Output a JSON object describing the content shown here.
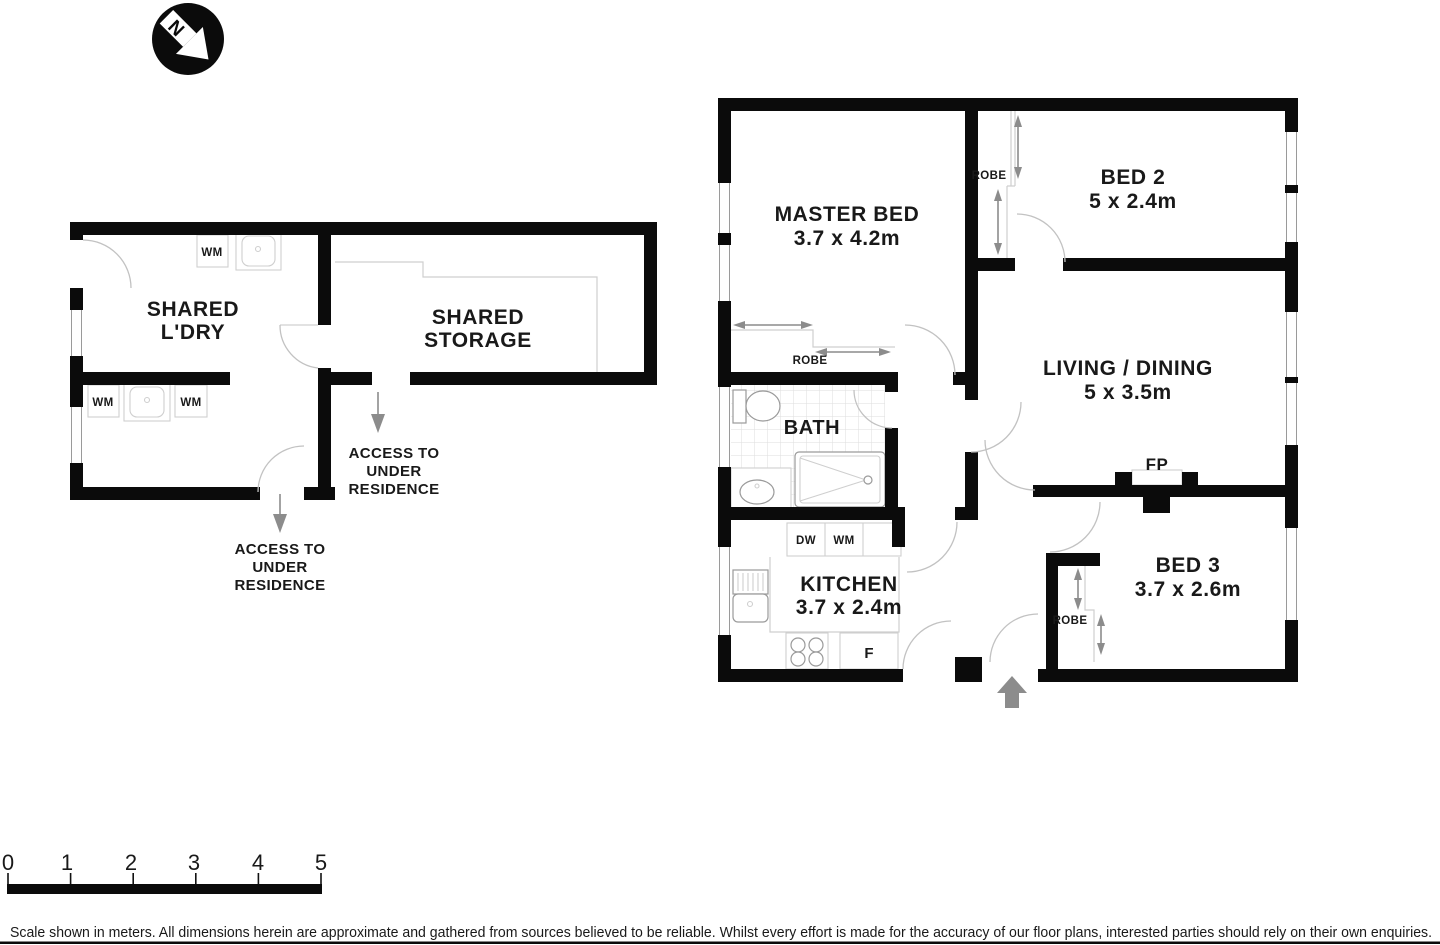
{
  "north": {
    "label": "N"
  },
  "out": {
    "laundry": {
      "l1": "SHARED",
      "l2": "L'DRY"
    },
    "storage": {
      "l1": "SHARED",
      "l2": "STORAGE"
    },
    "wm": "WM",
    "access": {
      "l1": "ACCESS TO",
      "l2": "UNDER",
      "l3": "RESIDENCE"
    }
  },
  "res": {
    "master": {
      "name": "MASTER BED",
      "dims": "3.7 x 4.2m"
    },
    "bed2": {
      "name": "BED 2",
      "dims": "5 x 2.4m"
    },
    "living": {
      "name": "LIVING / DINING",
      "dims": "5 x 3.5m"
    },
    "bed3": {
      "name": "BED 3",
      "dims": "3.7 x 2.6m"
    },
    "kitchen": {
      "name": "KITCHEN",
      "dims": "3.7 x 2.4m"
    },
    "bath": {
      "name": "BATH"
    },
    "labels": {
      "robe": "ROBE",
      "fp": "FP",
      "dw": "DW",
      "wm": "WM",
      "fridge": "F"
    }
  },
  "scale": {
    "ticks": [
      "0",
      "1",
      "2",
      "3",
      "4",
      "5"
    ]
  },
  "disclaimer": "Scale shown in meters. All dimensions herein are approximate and gathered from sources believed to be  reliable. Whilst every effort is made for the accuracy of our floor plans, interested parties should rely on their own enquiries."
}
